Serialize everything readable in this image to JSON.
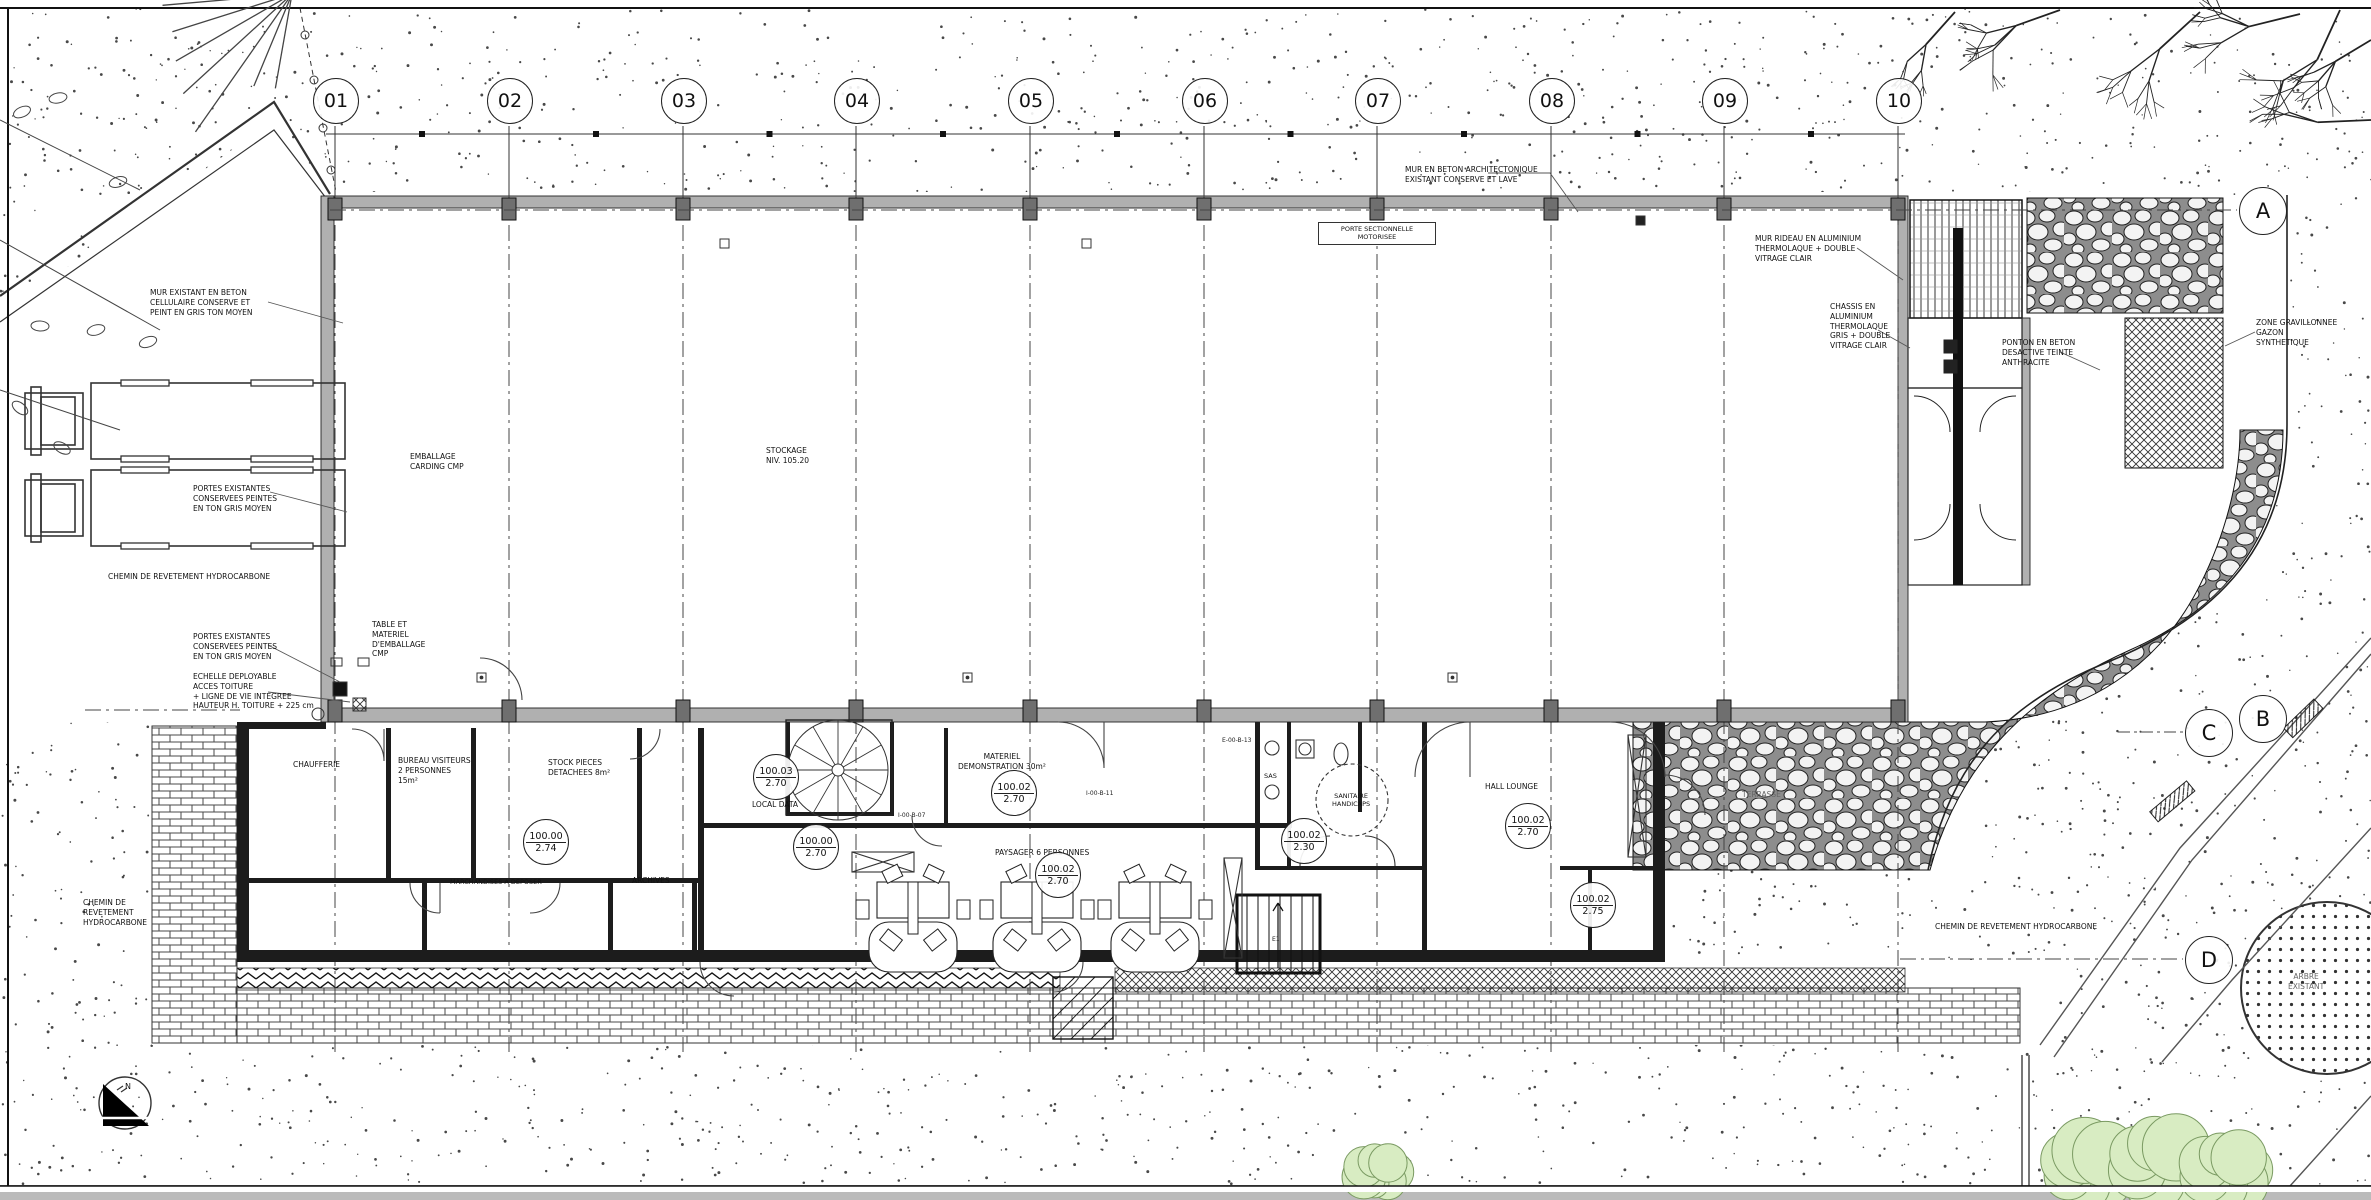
{
  "drawing": {
    "type_label": "PLAN REZ-DE-CHAUSSEE"
  },
  "grid": {
    "cols": [
      "01",
      "02",
      "03",
      "04",
      "05",
      "06",
      "07",
      "08",
      "09",
      "10"
    ],
    "rows": [
      "A",
      "B",
      "C",
      "D"
    ]
  },
  "compass": {
    "label": "N"
  },
  "colors": {
    "paper": "#ffffff",
    "ink": "#1a1a1a",
    "wall_gray": "#b0b0b0",
    "bush_green": "#d8ecc2"
  },
  "annotations": {
    "mur_cellulaire": "MUR EXISTANT EN BETON\nCELLULAIRE CONSERVE ET\nPEINT EN GRIS TON MOYEN",
    "portes_truck": "PORTES EXISTANTES\nCONSERVEES PEINTES\nEN TON GRIS MOYEN",
    "portes_wall": "PORTES EXISTANTES\nCONSERVEES PEINTES\nEN TON GRIS MOYEN",
    "echelle": "ECHELLE DEPLOYABLE\nACCES TOITURE\n+ LIGNE DE VIE INTEGREE\nHAUTEUR H. TOITURE + 225 cm",
    "table_emballage": "TABLE ET\nMATERIEL\nD'EMBALLAGE\nCMP",
    "chemin_bas": "CHEMIN DE REVETEMENT HYDROCARBONE",
    "chemin_gauche": "CHEMIN DE\nREVETEMENT\nHYDROCARBONE",
    "chemin_droite": "CHEMIN DE REVETEMENT HYDROCARBONE",
    "mur_archi": "MUR EN BETON ARCHITECTONIQUE\nEXISTANT CONSERVE ET LAVE",
    "mur_rideau": "MUR RIDEAU EN ALUMINIUM\nTHERMOLAQUE + DOUBLE\nVITRAGE CLAIR",
    "chassis": "CHASSIS EN\nALUMINIUM\nTHERMOLAQUE\nGRIS + DOUBLE\nVITRAGE CLAIR",
    "ponton": "PONTON EN BETON\nDESACTIVE TEINTE\nANTHRACITE",
    "gravillon": "ZONE GRAVILLONNEE\nGAZON\nSYNTHETIQUE",
    "porte_section": "PORTE SECTIONNELLE\nMOTORISEE"
  },
  "rooms": {
    "chaufferie": "CHAUFFERIE",
    "bureau": "BUREAU VISITEURS\n2 PERSONNES\n15m²",
    "stock": "STOCK PIECES\nDETACHEES 8m²",
    "marchandises": "MARCHANDISES A DEPOSER",
    "archives": "ARCHIVES",
    "local_data": "LOCAL DATA",
    "materiel": "MATERIEL\nDEMONSTRATION 30m²",
    "paysager": "PAYSAGER 6 PERSONNES",
    "hall_lounge": "HALL LOUNGE",
    "sanitaire": "SANITAIRE\nHANDICAPS",
    "sas": "SAS",
    "emballage": "EMBALLAGE\nCARDING CMP",
    "stockage": "STOCKAGE\nNIV. 105.20",
    "terrasse": "TERRASSE",
    "arbre": "ARBRE\nEXISTANT"
  },
  "door_tags": {
    "t1": "I-00-B-07",
    "t2": "I-00-B-11",
    "t3": "E-00-B-13",
    "e1": "E1"
  },
  "levels": [
    {
      "top": "100.00",
      "bottom": "2.74"
    },
    {
      "top": "100.03",
      "bottom": "2.70"
    },
    {
      "top": "100.00",
      "bottom": "2.70"
    },
    {
      "top": "100.02",
      "bottom": "2.70"
    },
    {
      "top": "100.02",
      "bottom": "2.70"
    },
    {
      "top": "100.02",
      "bottom": "2.30"
    },
    {
      "top": "100.02",
      "bottom": "2.70"
    },
    {
      "top": "100.02",
      "bottom": "2.75"
    }
  ]
}
